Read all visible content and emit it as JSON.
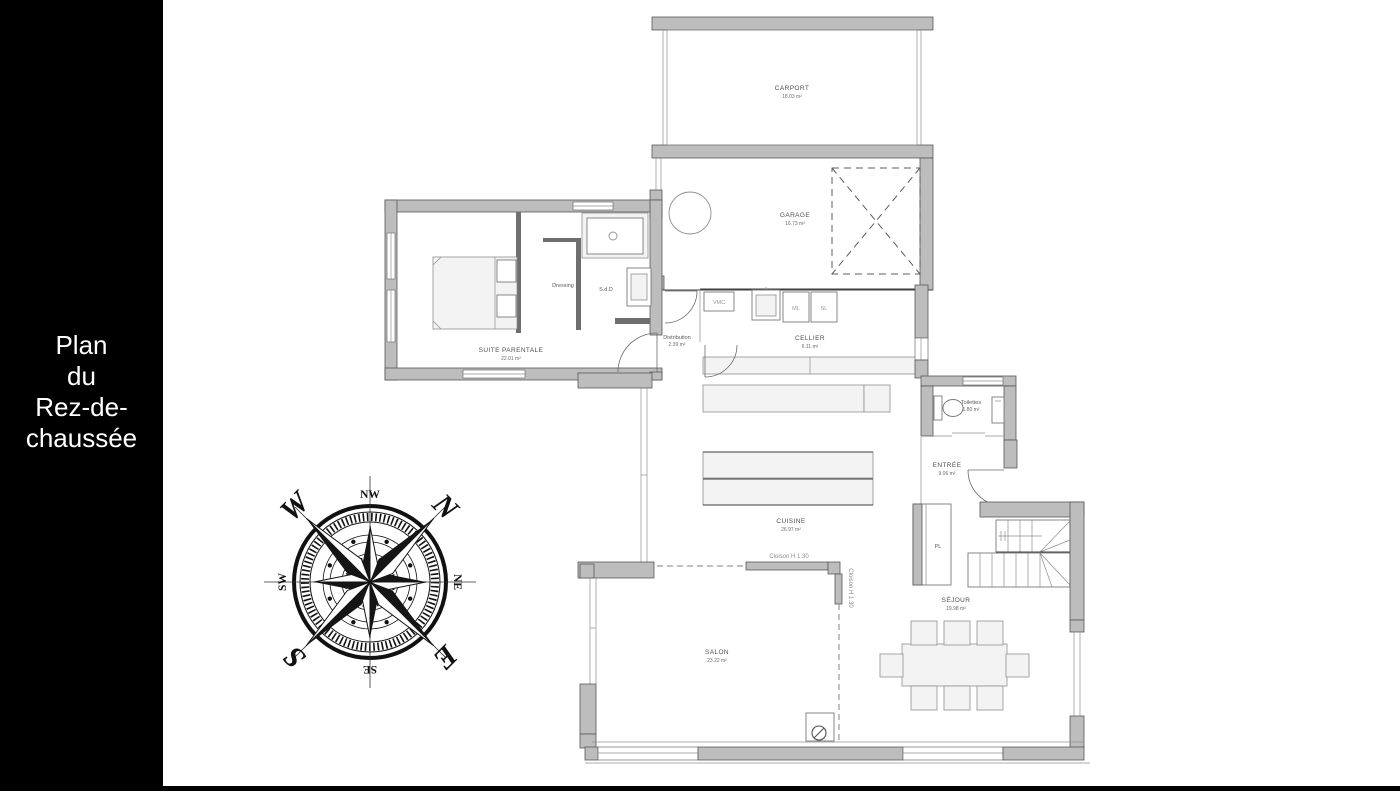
{
  "sidebar": {
    "title_lines": [
      "Plan",
      "du",
      "Rez-de-",
      "chaussée"
    ]
  },
  "plan": {
    "rooms": {
      "carport": {
        "name": "CARPORT",
        "area": "18.03 m²"
      },
      "garage": {
        "name": "GARAGE",
        "area": "16.73 m²"
      },
      "cellier": {
        "name": "CELLIER",
        "area": "6.11 m²"
      },
      "suite": {
        "name": "SUITE PARENTALE",
        "area": "22.01 m²"
      },
      "dressing": {
        "name": "Dressing"
      },
      "sdd": {
        "name": "S.d.D"
      },
      "distribution": {
        "name": "Distribution",
        "area": "2.39 m²"
      },
      "cuisine": {
        "name": "CUISINE",
        "area": "26.97 m²"
      },
      "toilettes": {
        "name": "Toilettes",
        "area": "1.80 m²"
      },
      "entree": {
        "name": "ENTRÉE",
        "area": "9.06 m²"
      },
      "pl": {
        "name": "PL"
      },
      "sejour": {
        "name": "SÉJOUR",
        "area": "19.98 m²"
      },
      "salon": {
        "name": "SALON",
        "area": "23.22 m²"
      }
    },
    "labels": {
      "vmc": "VMC",
      "ml": "ML",
      "sl": "SL",
      "cloison_h": "Cloison H 1.30",
      "cloison_v": "Cloison H 1.30"
    },
    "compass": {
      "n": "N",
      "e": "E",
      "s": "S",
      "w": "W",
      "ne": "NE",
      "se": "SE",
      "sw": "SW",
      "nw": "NW",
      "rotation_deg": 45
    }
  },
  "colors": {
    "sidebar_bg": "#000000",
    "sidebar_text": "#ffffff",
    "wall_fill": "#bdbdbd",
    "wall_stroke": "#585858",
    "label_text": "#4f4f4f"
  }
}
